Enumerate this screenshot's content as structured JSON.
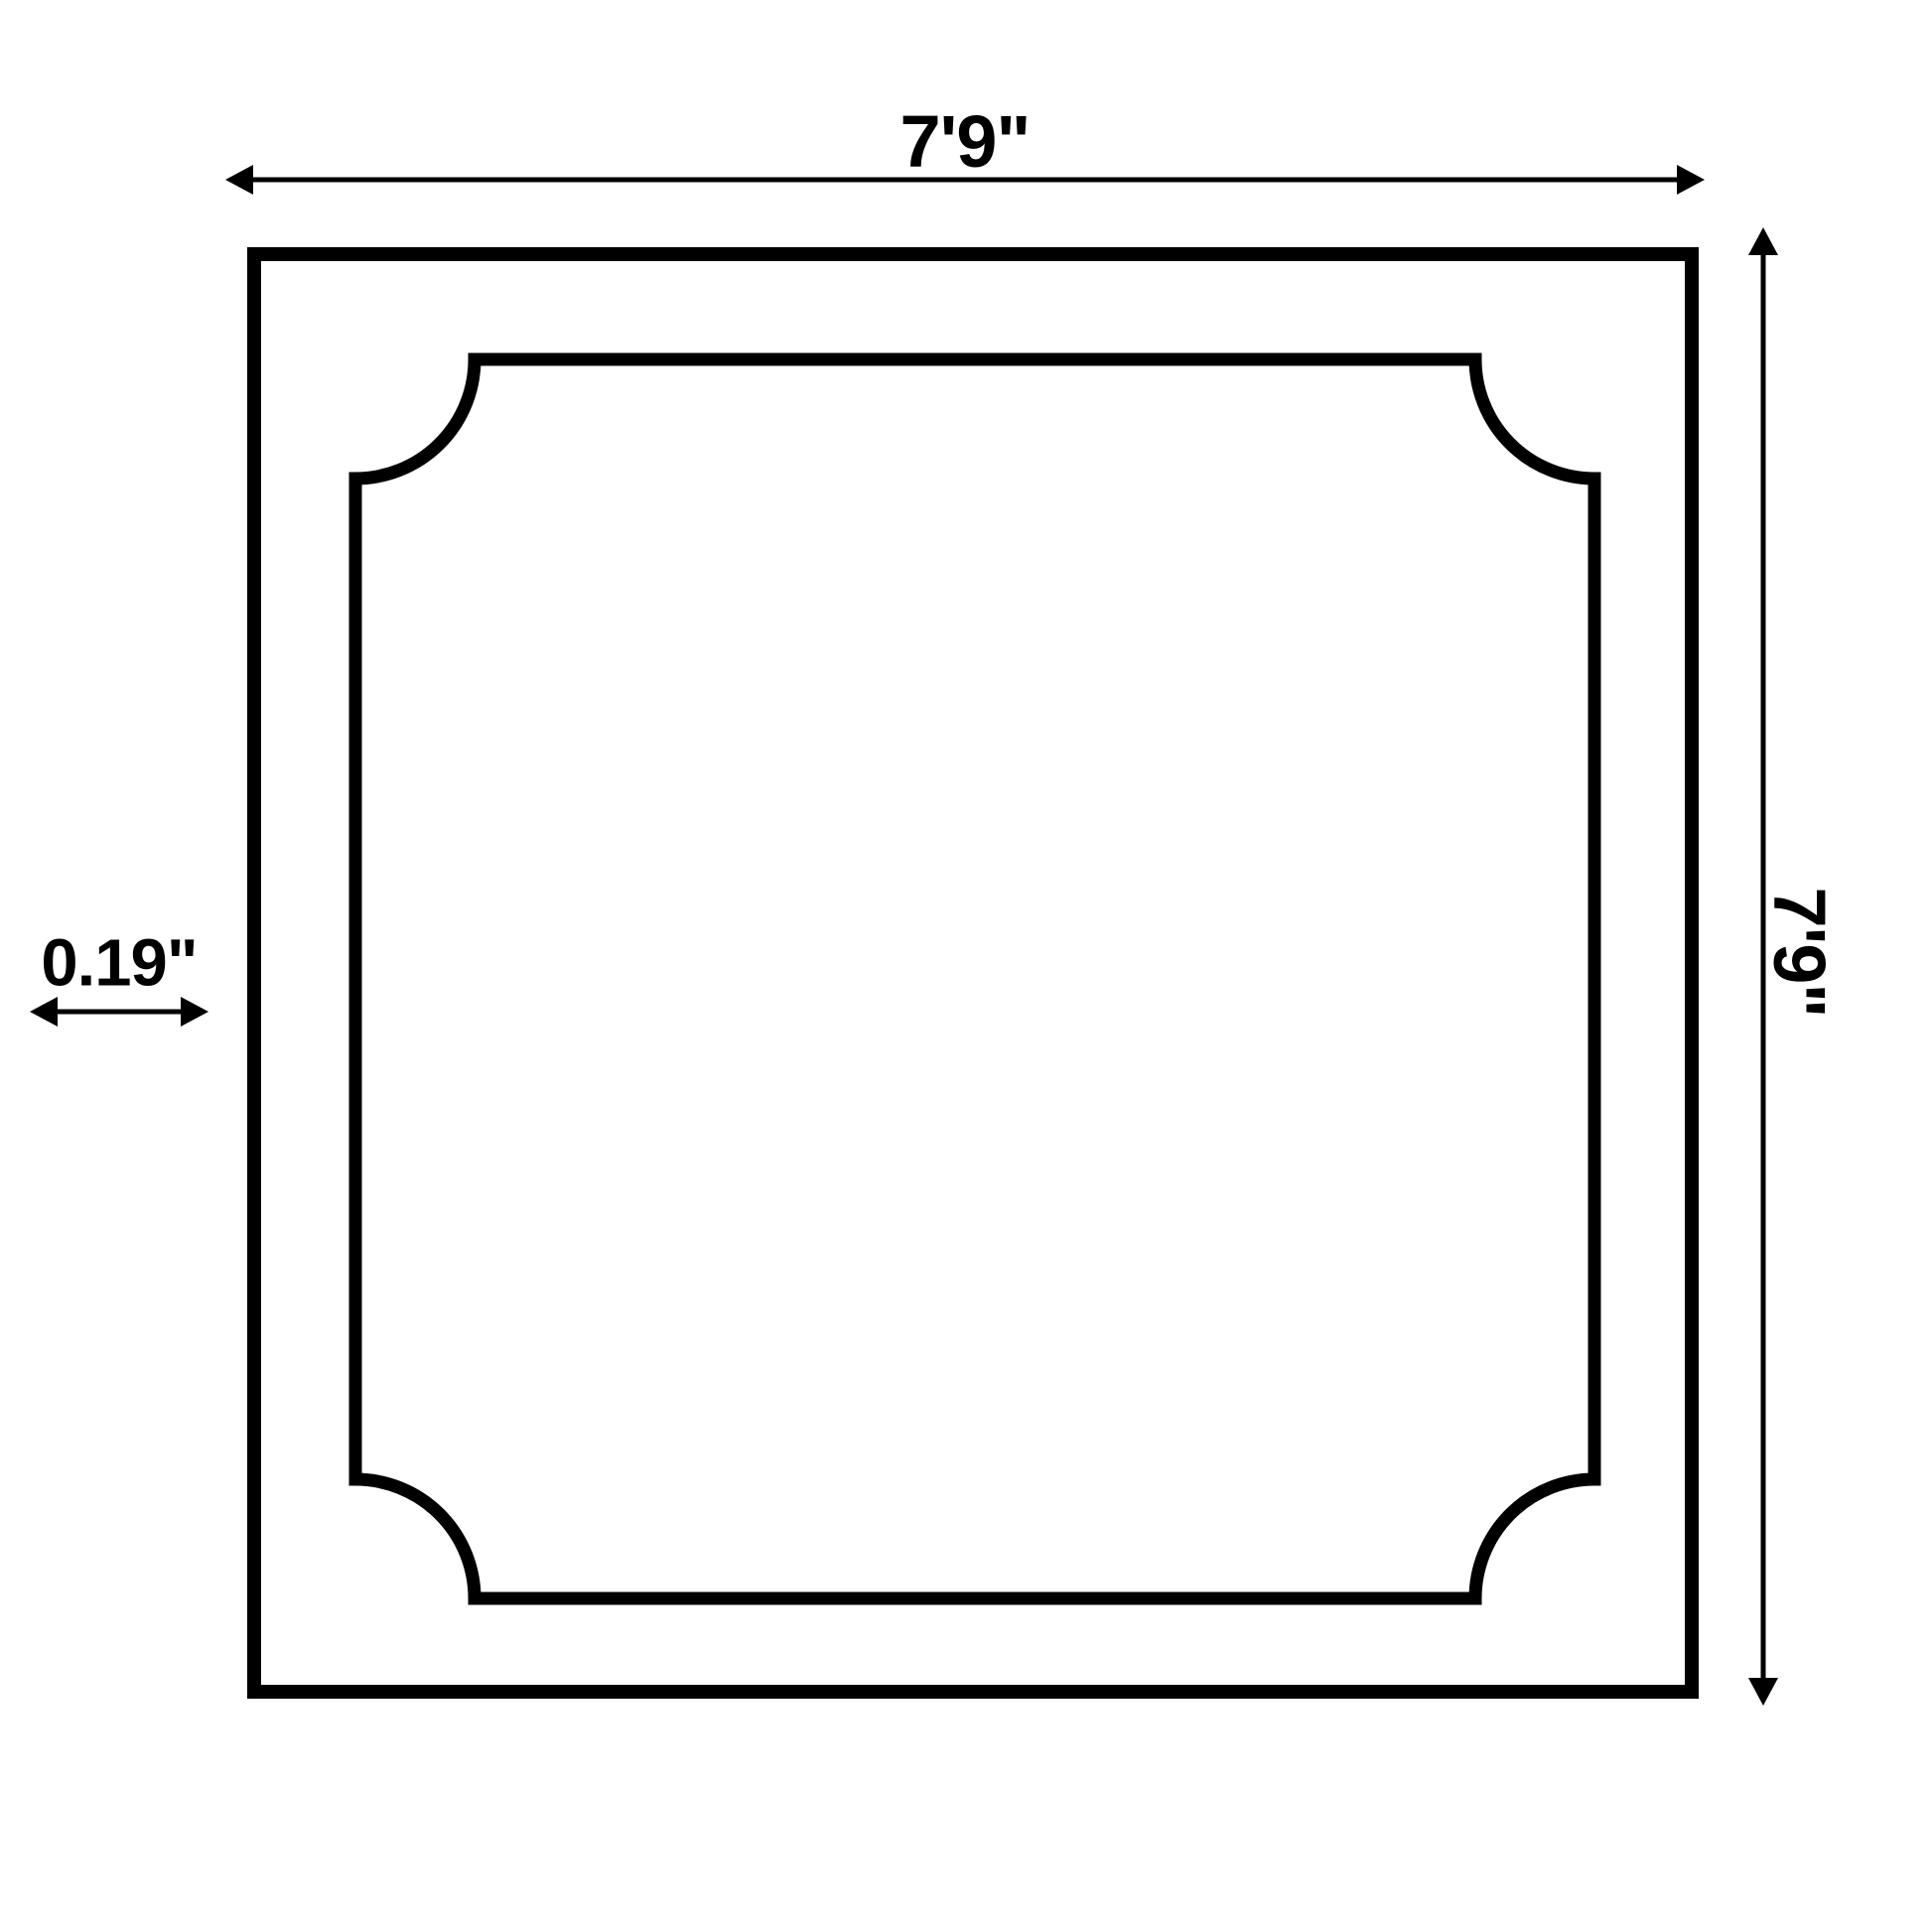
{
  "diagram": {
    "type": "dimension-drawing",
    "colors": {
      "line": "#000000",
      "background": "#ffffff"
    },
    "dimensions": {
      "top": {
        "label": "7'9\"",
        "orientation": "horizontal"
      },
      "right": {
        "label": "7'9\"",
        "orientation": "vertical"
      },
      "left": {
        "label": "0.19\"",
        "orientation": "horizontal"
      }
    }
  }
}
